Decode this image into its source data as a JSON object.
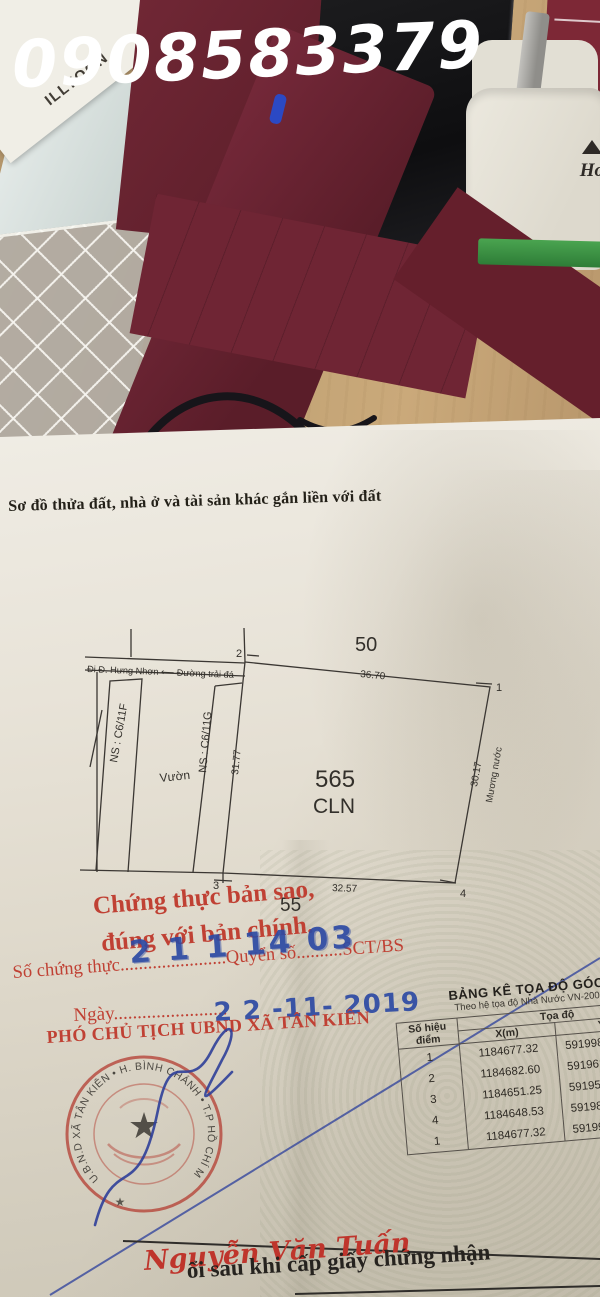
{
  "watermark": "0908583379",
  "desk": {
    "label_text": "ILLYOON",
    "holder_text": "Ho"
  },
  "document": {
    "title": "Sơ đồ thửa đất, nhà ở và tài sản khác gắn liền với đất",
    "diagram": {
      "road_label": "Đi Đ. Hưng Nhơn ⟵  Đường trải đá",
      "adjacent_plot_top": "50",
      "adjacent_plot_bottom": "55",
      "parcel_number": "565",
      "parcel_land_use": "CLN",
      "neighbor_left_1": "NS : C6/11F",
      "neighbor_left_2": "NS : C6/11G",
      "garden_label": "Vườn",
      "canal_label": "Mương nước",
      "edge_top": "36.70",
      "edge_left": "31.77",
      "edge_right": "30.17",
      "edge_bottom": "32.57",
      "p1": "1",
      "p2": "2",
      "p3": "3",
      "p4": "4"
    },
    "certification": {
      "line1": "Chứng thực bản sao,",
      "line2": "đúng với bản chính.",
      "serial_label": "Số chứng thực",
      "serial_dots": ".......................",
      "book_label": "Quyển số",
      "book_dots": "..........",
      "book_suffix": "SCT/BS",
      "serial_stamp": "2 1 1 14 03",
      "date_label": "Ngày",
      "date_dots": "........................",
      "date_stamp": "2 2 -11- 2019",
      "signer_title": "PHÓ CHỦ TỊCH UBND XÃ TÂN KIÊN",
      "signer_name": "Nguyễn Văn Tuấn",
      "stamp_ring_text": "U.B.N.D XÃ TÂN KIÊN • H. BÌNH CHÁNH • T.P HỒ CHÍ M",
      "stamp_star": "★",
      "stamp_star_small": "★"
    },
    "coordinate_table": {
      "title": "BẢNG KÊ TỌA ĐỘ GÓC RANH",
      "subtitle": "Theo hệ tọa độ Nhà Nước VN-2000",
      "col_point": "Số hiệu điểm",
      "col_coords": "Tọa độ",
      "col_x": "X(m)",
      "col_y": "Y(m)",
      "rows": [
        {
          "point": "1",
          "x": "1184677.32",
          "y": "591998.16"
        },
        {
          "point": "2",
          "x": "1184682.60",
          "y": "591961.8"
        },
        {
          "point": "3",
          "x": "1184651.25",
          "y": "591956.6"
        },
        {
          "point": "4",
          "x": "1184648.53",
          "y": "591989."
        },
        {
          "point": "1",
          "x": "1184677.32",
          "y": "591998."
        }
      ]
    },
    "footer_text": "ổi sau khi cấp giấy chứng nhận"
  }
}
